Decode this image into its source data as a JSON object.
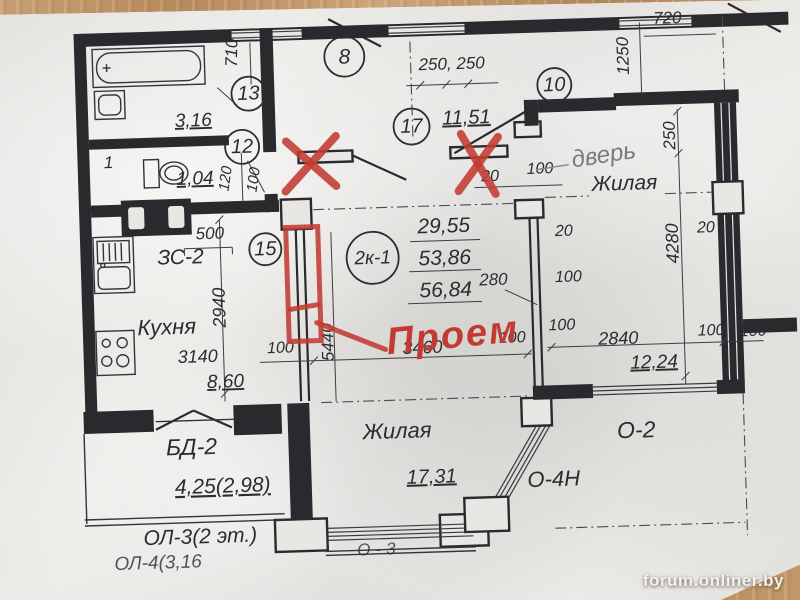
{
  "watermark": "forum.onliner.by",
  "unit": {
    "id": "2к-1",
    "area_living": "29,55",
    "area_total": "53,86",
    "area_full": "56,84"
  },
  "callouts": {
    "c8": "8",
    "c10": "10",
    "c12": "12",
    "c13": "13",
    "c15": "15",
    "c17": "17"
  },
  "rooms": {
    "bath": {
      "area": "3,16"
    },
    "wc": {
      "number": "1",
      "area": "1,04"
    },
    "hall": {
      "area": "11,51"
    },
    "kitchen": {
      "name": "Кухня",
      "area": "8,60"
    },
    "living_right": {
      "name": "Жилая",
      "area": "12,24"
    },
    "living_bottom": {
      "name": "Жилая",
      "area": "17,31"
    },
    "balcony_door": {
      "code": "БД-2",
      "area": "4,25(2,98)"
    },
    "loggia": {
      "code": "ОЛ-3(2 эт.)",
      "code_next": "ОЛ-4(3,16"
    },
    "window_right": {
      "code": "О-2"
    },
    "window_angled": {
      "code": "О-4Н"
    },
    "window_bottom": {
      "code": "О-3"
    },
    "entry_unit": {
      "code": "ЗС-2"
    }
  },
  "dims": {
    "d710": "710",
    "d120": "120",
    "d100_wc": "100",
    "d250x2": "250, 250",
    "d720": "720",
    "d1250": "1250",
    "d250": "250",
    "d4280": "4280",
    "d20_door": "20",
    "d100_door": "100",
    "d20_wall": "20",
    "d100_wall": "100",
    "d100_a": "100",
    "d500": "500",
    "d2940": "2940",
    "d3140": "3140",
    "d5440": "5440",
    "d3460": "3460",
    "d100_b": "100",
    "d100_c": "100",
    "d2840": "2840",
    "d100_d": "100",
    "d100_e": "100",
    "d20_right": "20",
    "d280": "280"
  },
  "annotations": {
    "red_opening": "Проем",
    "pencil_door": "дверь"
  },
  "colors": {
    "ink": "#2a2a2e",
    "red_marker": "#c13b32",
    "pencil": "#7a7a7e",
    "paper": "#e9e7e3",
    "wood": "#b8895c"
  }
}
